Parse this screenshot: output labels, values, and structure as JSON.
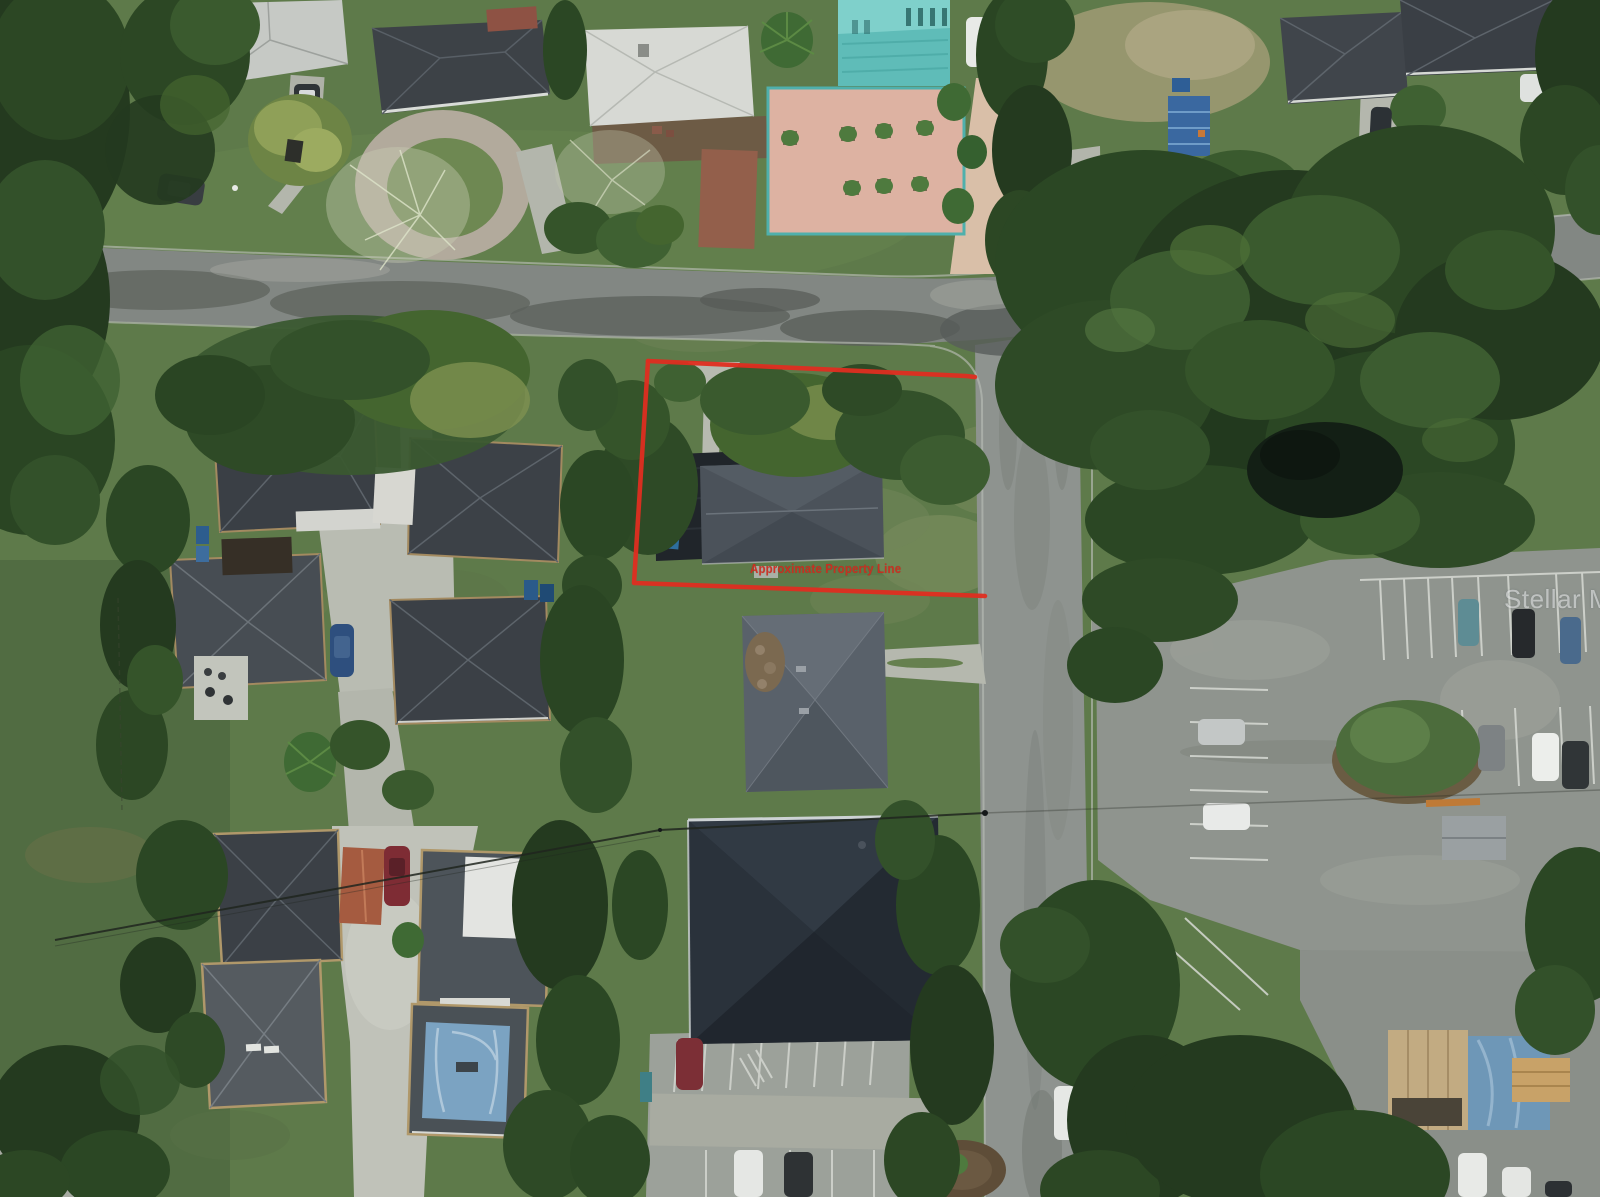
{
  "scene": {
    "description": "Overhead aerial drone photograph of a suburban residential block, overcast with wet streets; a vacant corner lot containing a small dark-roofed house is outlined in red",
    "features": [
      "horizontal-street-top",
      "vertical-street-right-center",
      "t-intersection",
      "outlined-vacant-lot-with-house",
      "circular-paver-driveway",
      "teal-building-with-salmon-courtyard",
      "four-house-compound-left",
      "tan-townhouses-bottom-left-with-blue-tarp-roof",
      "large-dark-roof-building-bottom-center",
      "parking-lots-right-with-cars",
      "dense-oak-tree-canopies",
      "power-lines"
    ]
  },
  "overlay": {
    "property_line_label": "Approximate Property Line",
    "line_color": "#df2d20",
    "label_color": "#cf2b1f"
  },
  "watermark": {
    "text": "Stellar MLS",
    "color": "rgba(255,255,255,0.5)"
  },
  "palette": {
    "grass": "#5e7a4a",
    "tree_dark": "#243a1f",
    "asphalt_wet": "#878c88",
    "concrete": "#b9bcb2",
    "roof_charcoal": "#3c4147",
    "roof_gray": "#59616a",
    "courtyard_salmon": "#ddb2a2",
    "teal_building": "#5fbcb8",
    "blue_tarp": "#7ba3c2"
  }
}
